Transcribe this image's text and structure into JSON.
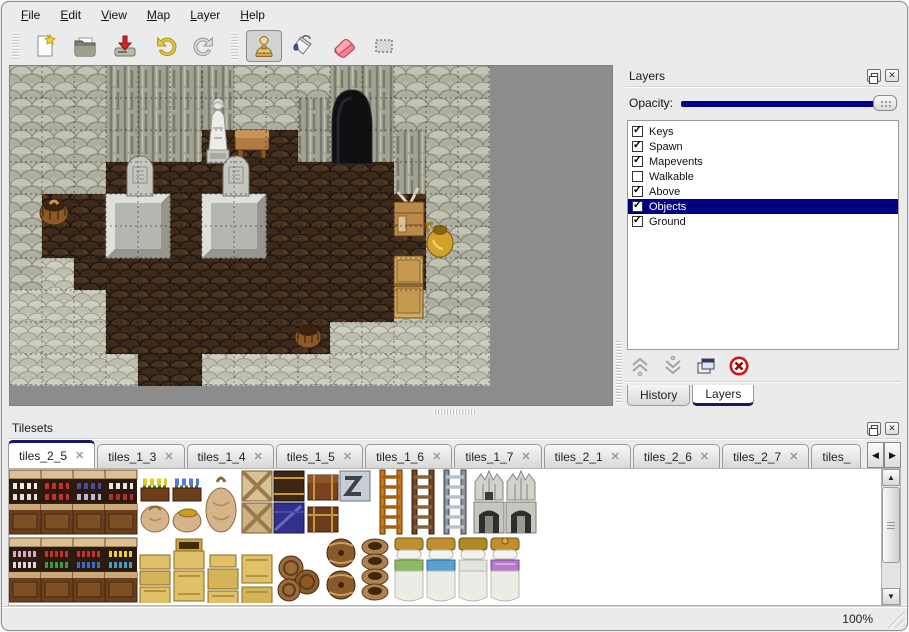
{
  "menu": {
    "items": [
      {
        "label": "File"
      },
      {
        "label": "Edit"
      },
      {
        "label": "View"
      },
      {
        "label": "Map"
      },
      {
        "label": "Layer"
      },
      {
        "label": "Help"
      }
    ]
  },
  "toolbar": {
    "buttons": [
      {
        "icon": "new-file-icon"
      },
      {
        "icon": "open-folder-icon"
      },
      {
        "icon": "save-icon"
      },
      {
        "icon": "undo-icon"
      },
      {
        "icon": "redo-icon"
      },
      {
        "icon": "stamp-tool-icon",
        "selected": true
      },
      {
        "icon": "fill-tool-icon"
      },
      {
        "icon": "eraser-tool-icon"
      },
      {
        "icon": "rect-select-tool-icon"
      }
    ]
  },
  "map_view": {
    "tile_grid": [
      "WWWDDDDWWWDDWWW",
      "WWWDDDDWWDDDWWW",
      "WWWDDDFFFDDDDWW",
      "WWWFFFFFFFFFDWW",
      "WFFFFFFFFFFFFWW",
      "WFFFFFFFFFFFFWW",
      "WLFFFFFFFFFFFWW",
      "LLLFFFFFFFFFLWW",
      "LLLFFFFFFFLLLLL",
      "LLLLFFLLLLLLLLL"
    ],
    "objects": [
      "cave-entrance",
      "statue",
      "table",
      "tombstone",
      "tombstone",
      "stone-slab",
      "stone-slab",
      "crate-with-tools",
      "cabinet",
      "gold-vase",
      "basket",
      "basket"
    ]
  },
  "layers_panel": {
    "title": "Layers",
    "opacity_label": "Opacity:",
    "layers": [
      {
        "name": "Keys",
        "checked": true,
        "selected": false
      },
      {
        "name": "Spawn",
        "checked": true,
        "selected": false
      },
      {
        "name": "Mapevents",
        "checked": true,
        "selected": false
      },
      {
        "name": "Walkable",
        "checked": false,
        "selected": false
      },
      {
        "name": "Above",
        "checked": true,
        "selected": false
      },
      {
        "name": "Objects",
        "checked": true,
        "selected": true
      },
      {
        "name": "Ground",
        "checked": true,
        "selected": false
      }
    ],
    "tabs": [
      {
        "label": "History",
        "active": false
      },
      {
        "label": "Layers",
        "active": true
      }
    ]
  },
  "tilesets_panel": {
    "title": "Tilesets",
    "tabs": [
      {
        "label": "tiles_2_5",
        "active": true
      },
      {
        "label": "tiles_1_3",
        "active": false
      },
      {
        "label": "tiles_1_4",
        "active": false
      },
      {
        "label": "tiles_1_5",
        "active": false
      },
      {
        "label": "tiles_1_6",
        "active": false
      },
      {
        "label": "tiles_1_7",
        "active": false
      },
      {
        "label": "tiles_2_1",
        "active": false
      },
      {
        "label": "tiles_2_6",
        "active": false
      },
      {
        "label": "tiles_2_7",
        "active": false
      },
      {
        "label": "tiles_",
        "active": false
      }
    ]
  },
  "status_bar": {
    "zoom_level": "100%"
  },
  "icons": {
    "check_glyph": "✓",
    "tab_close_glyph": "✕",
    "panel_close_glyph": "✕",
    "scroll_up_glyph": "▲",
    "scroll_down_glyph": "▼",
    "tab_scroll_left_glyph": "◀",
    "tab_scroll_right_glyph": "▶"
  },
  "colors": {
    "accent_navy": "#00008b",
    "selection_navy": "#000080"
  }
}
